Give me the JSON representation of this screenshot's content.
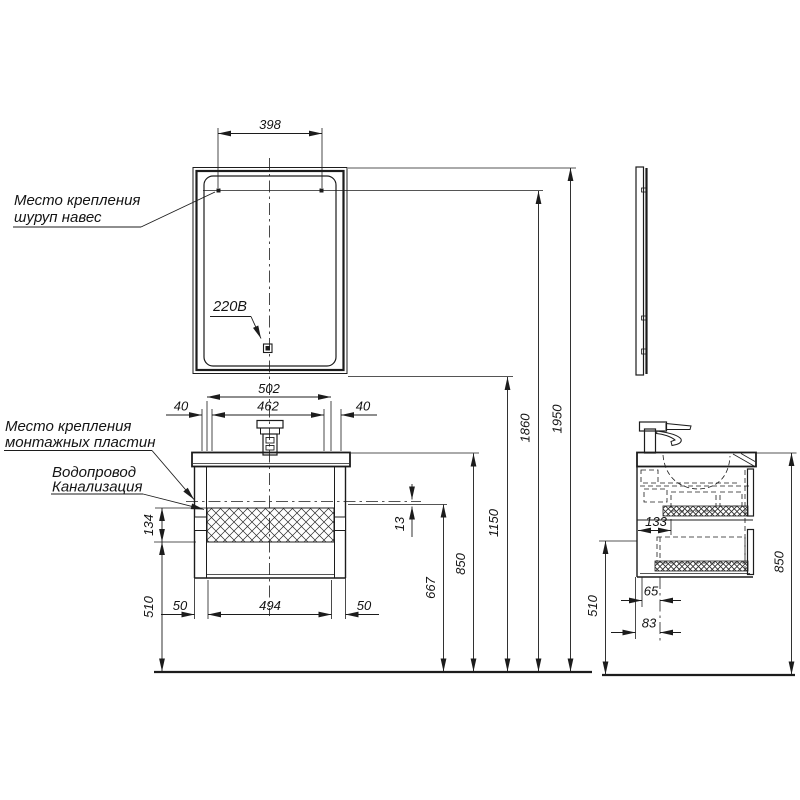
{
  "annotations": {
    "mirror_mount_line1": "Место крепления",
    "mirror_mount_line2": "шуруп навес",
    "plate_mount_line1": "Место крепления",
    "plate_mount_line2": "монтажных пластин",
    "plumbing_line1": "Водопровод",
    "plumbing_line2": "Канализация",
    "power": "220В"
  },
  "front_view": {
    "dims": {
      "mount_span": "398",
      "counter_width": "502",
      "inner_width": "462",
      "overhang_left": "40",
      "overhang_right": "40",
      "base_width": "494",
      "base_inset_left": "50",
      "base_inset_right": "50",
      "panel_height": "134",
      "underside_height": "510",
      "drain_gap": "13",
      "drain_height": "667",
      "counter_height": "850",
      "mirror_bottom_height": "1150",
      "mirror_mount_height": "1860",
      "total_height": "1950"
    }
  },
  "side_view": {
    "dims": {
      "mount_depth": "133",
      "drain_offset": "65",
      "supply_offset": "83",
      "underside_height": "510",
      "counter_height": "850"
    }
  },
  "colors": {
    "ink": "#1c1c1c",
    "background": "#ffffff"
  }
}
